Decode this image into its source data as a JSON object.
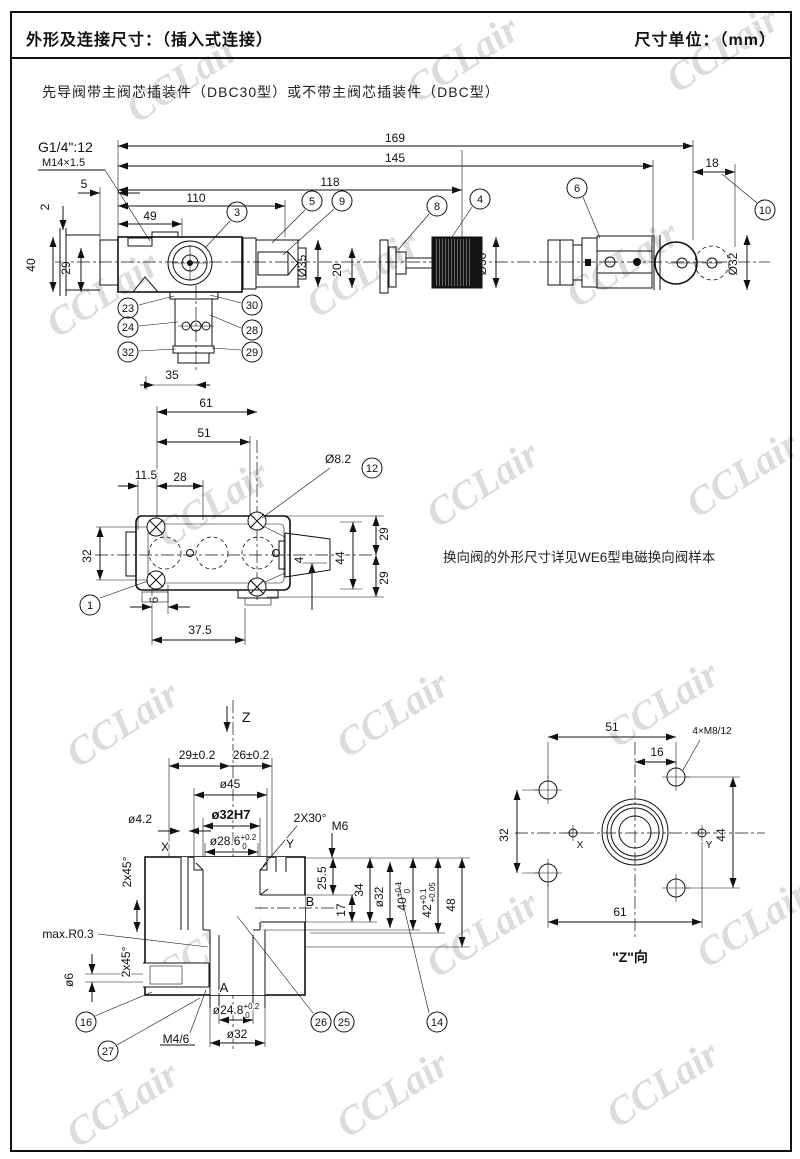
{
  "header": {
    "title": "外形及连接尺寸：（插入式连接）",
    "unit": "尺寸单位：（mm）"
  },
  "subtitle": "先导阀带主阀芯插装件（DBC30型）或不带主阀芯插装件（DBC型）",
  "note": "换向阀的外形尺寸详见WE6型电磁换向阀样本",
  "watermark": "CCLair",
  "view1": {
    "port": "G1/4\":12",
    "thread": "M14×1.5",
    "d169": "169",
    "d145": "145",
    "d118": "118",
    "d110": "110",
    "d49": "49",
    "d5": "5",
    "d2": "2",
    "d40": "40",
    "d29": "29",
    "d18": "18",
    "d35dia": "Ø35",
    "d20": "20",
    "d30": "Ø30",
    "d32": "Ø32",
    "d35": "35",
    "b3": "3",
    "b5": "5",
    "b9": "9",
    "b8": "8",
    "b4": "4",
    "b6": "6",
    "b10": "10",
    "b23": "23",
    "b24": "24",
    "b32": "32",
    "b30": "30",
    "b28": "28",
    "b29": "29"
  },
  "view2": {
    "d61": "61",
    "d51": "51",
    "d28": "28",
    "d115": "11.5",
    "d82": "Ø8.2",
    "d32": "32",
    "d29a": "29",
    "d44": "44",
    "d29b": "29",
    "d4": "4",
    "d6": "6",
    "d375": "37.5",
    "b12": "12",
    "b1": "1"
  },
  "view3": {
    "z": "Z",
    "d29": "29±0.2",
    "d26": "26±0.2",
    "d45": "ø45",
    "d42": "ø4.2",
    "d32h7": "ø32H7",
    "d286": "ø28.6",
    "d286sup": "+0.2",
    "d286sub": "0",
    "chamfer30": "2X30°",
    "m6": "M6",
    "x": "X",
    "y": "Y",
    "b": "B",
    "a": "A",
    "chamfer45a": "2x45°",
    "chamfer45b": "2x45°",
    "maxr": "max.R0.3",
    "d6dia": "ø6",
    "d255": "25.5",
    "d17": "17",
    "d34": "34",
    "d32dia": "ø32",
    "d40": "40",
    "d40sup": "+0.1",
    "d40sub": "0",
    "d42t": "42",
    "d42sup": "+0.1",
    "d42sub": "+0.05",
    "d48": "48",
    "d248": "ø24.8",
    "d248sup": "+0.2",
    "d248sub": "0",
    "d32b": "ø32",
    "m46": "M4/6",
    "b16": "16",
    "b27": "27",
    "b26": "26",
    "b25": "25",
    "b14": "14"
  },
  "view4": {
    "d51": "51",
    "d16": "16",
    "dm8": "4×M8/12",
    "d32": "32",
    "d44": "44",
    "d61": "61",
    "x": "X",
    "y": "Y",
    "label": "\"Z\"向"
  }
}
